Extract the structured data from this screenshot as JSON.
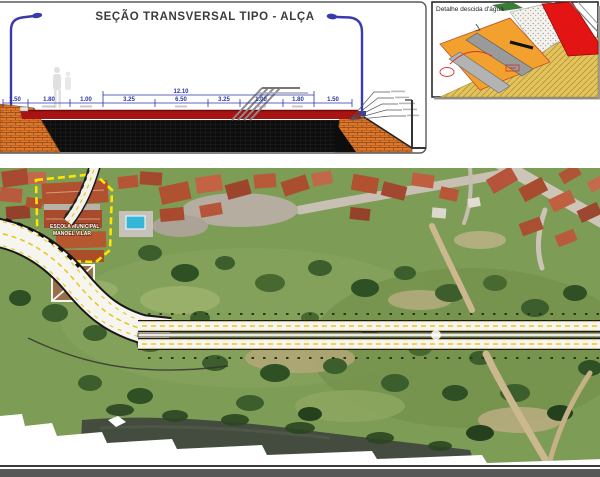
{
  "cross_section": {
    "title": "SEÇÃO TRANSVERSAL TIPO - ALÇA",
    "total_width_label": "12.10",
    "dimension_labels": [
      "1.50",
      "1.80",
      "1.00",
      "3.25",
      "6.50",
      "3.25",
      "1.00",
      "1.80",
      "1.50"
    ],
    "colors": {
      "dimension_text": "#2a35a8",
      "road_surface": "#a81313",
      "asphalt_base": "#0d0d0d",
      "stone_facing": "#e0762a",
      "light_pole": "#3a3aad"
    }
  },
  "detail": {
    "title": "Detalhe descida d'água",
    "colors": {
      "embankment": "#f2a02e",
      "road": "#e21414",
      "chute": "#9a9a9a",
      "ground": "#e3c45c"
    }
  },
  "aerial": {
    "school_label": {
      "line1": "ESCOLA MUNICIPAL",
      "line2": "MANOEL VILAR"
    },
    "colors": {
      "school_boundary": "#ffe400",
      "road_surface": "#f6f5ef",
      "lane_marking": "#e8c820"
    }
  }
}
